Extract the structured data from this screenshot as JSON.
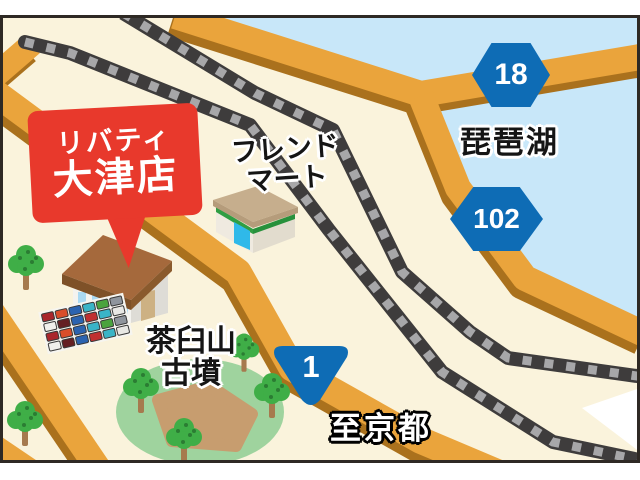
{
  "map": {
    "title_bubble": {
      "line1": "リバティ",
      "line2": "大津店"
    },
    "labels": {
      "convenience_store_line1": "フレンド",
      "convenience_store_line2": "マート",
      "lake": "琵琶湖",
      "kofun_line1": "茶臼山",
      "kofun_line2": "古墳",
      "direction_kyoto": "至京都"
    },
    "route_shields": [
      {
        "type": "prefectural-route",
        "number": "18"
      },
      {
        "type": "prefectural-route",
        "number": "102"
      },
      {
        "type": "national-route",
        "number": "1"
      }
    ],
    "colors": {
      "land": "#FAF3DC",
      "water": "#C8E7F9",
      "road": "#EAA43C",
      "road_shadow": "#AA711D",
      "railway_dark": "#3E3C3C",
      "railway_light": "#A7A7A9",
      "bubble_red": "#E8392C",
      "shield_blue": "#0E6CB5",
      "mound_green": "#9FD39E",
      "tree_green": "#3FAE47"
    },
    "parking": {
      "colors": [
        "#a9262c",
        "#d94e2a",
        "#2b63b0",
        "#3ab4c7",
        "#4aa33e",
        "#8f959d",
        "#f0efeb",
        "#641f23",
        "#2b63b0",
        "#c03030",
        "#3ab4c7",
        "#e8e8e4"
      ]
    }
  }
}
